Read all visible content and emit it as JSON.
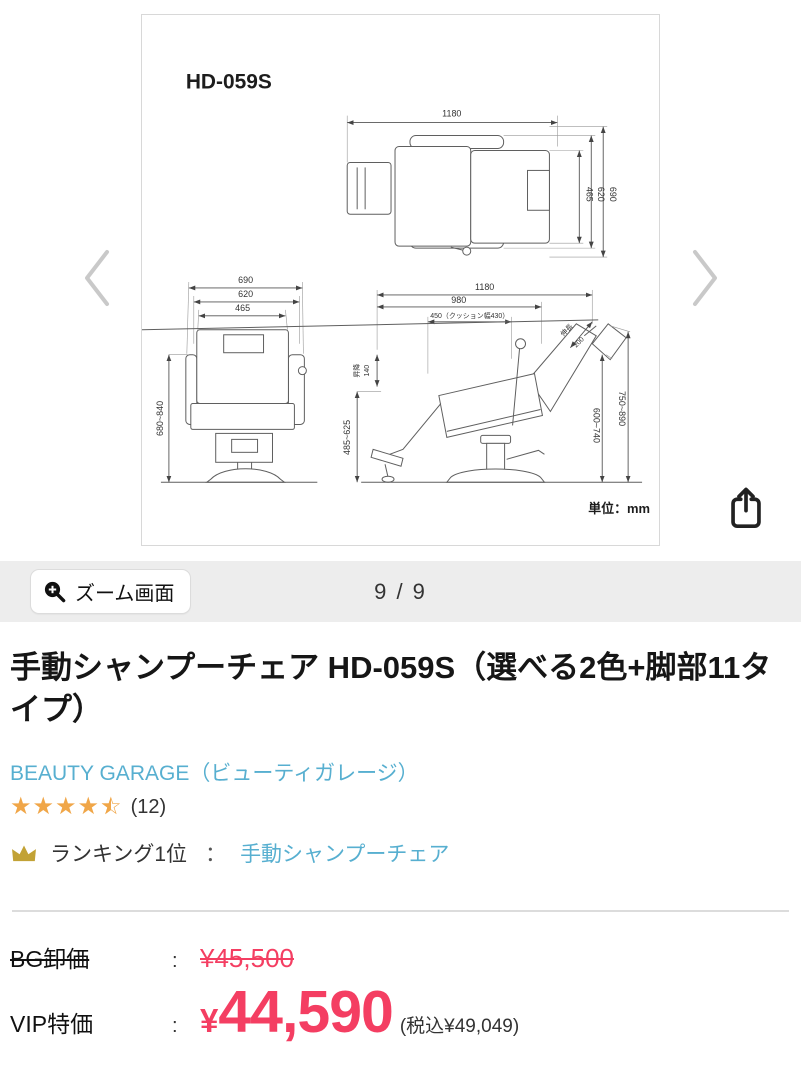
{
  "gallery": {
    "zoom_button_label": "ズーム画面",
    "page_indicator": "9 / 9",
    "diagram": {
      "model": "HD-059S",
      "unit": "単位：mm",
      "top_view": {
        "w_total": "1180",
        "d_465": "465",
        "d_620": "620",
        "d_690": "690"
      },
      "front_view": {
        "w_690": "690",
        "w_620": "620",
        "w_465": "465",
        "h_range": "680~840"
      },
      "side_view": {
        "w_total": "1180",
        "w_980": "980",
        "w_cushion": "450（クッション幅430）",
        "lift_label": "昇降",
        "lift_value": "140",
        "seat_height": "485~625",
        "h_inner": "600~740",
        "h_outer": "750~890",
        "ext_label": "伸長",
        "ext_value": "200"
      }
    }
  },
  "product": {
    "title": "手動シャンプーチェア HD-059S（選べる2色+脚部11タイプ）",
    "brand": "BEAUTY GARAGE（ビューティガレージ）",
    "rating": {
      "value": "4.5",
      "count": "(12)"
    },
    "ranking": {
      "label": "ランキング1位",
      "separator": "：",
      "category_link": "手動シャンプーチェア"
    }
  },
  "pricing": {
    "wholesale": {
      "label": "BG卸価",
      "colon": ":",
      "price": "¥45,500"
    },
    "vip": {
      "label": "VIP特価",
      "colon": ":",
      "currency": "¥",
      "amount": "44,590",
      "tax_note": "(税込¥49,049)"
    }
  },
  "colors": {
    "accent_pink": "#f43e62",
    "link_blue": "#57afd0",
    "star_orange": "#f0a648",
    "crown_gold": "#c2a235"
  }
}
